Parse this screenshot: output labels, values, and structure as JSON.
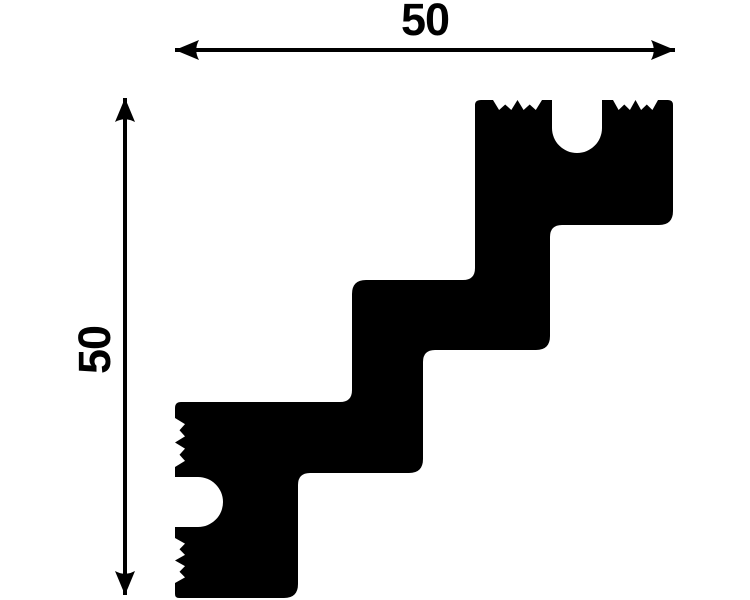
{
  "diagram": {
    "type": "molding-profile-cross-section",
    "background_color": "#ffffff",
    "shape_color": "#000000",
    "line_color": "#000000",
    "dimensions": {
      "width": {
        "value": "50",
        "orientation": "horizontal",
        "position": "top"
      },
      "height": {
        "value": "50",
        "orientation": "vertical",
        "position": "left"
      }
    },
    "geometry": {
      "profile_path": "M 481,100 L 493,100 L 499.1,110 L 505.2,104.5 L 511.3,110 L 517.5,100 L 523.6,110 L 529.7,104.5 L 535.8,110 L 542,100 L 552,100 L 552,128 A 25,25 0 0 0 602,128 L 602,100 L 613,100 L 618.6,110 L 624.3,104.5 L 629.9,110 L 635.5,100 L 641.1,110 L 646.8,104.5 L 652.4,110 L 658,100 L 668,100 Q 673,100 673,105 L 673,211 Q 673,225 659,225 L 562,225 Q 550,225 550,237 L 550,336 Q 550,350 536,350 L 435,350 Q 423,350 423,362 L 423,459 Q 423,473 409,473 L 310,473 Q 298,473 298,485 L 298,584 Q 298,598 284,598 L 179,598 Q 175,598 175,594 L 175,583 L 185,577.4 L 179.5,571.7 L 185,566.1 L 175,560.5 L 185,554.9 L 179.5,549.2 L 185,543.6 L 175,538 L 175,527 L 198,527 A 25,25 0 0 0 198,477 L 175,477 L 175,467 L 185,460.9 L 179.5,454.7 L 185,448.6 L 175,442.5 L 185,436.4 L 179.5,430.2 L 185,424.1 L 175,418 L 175,408 Q 175,402 181,402 L 340,402 Q 352,402 352,390 L 352,294 Q 352,280 366,280 L 463,280 Q 475,280 475,268 L 475,105 Q 475,100 481,100 Z",
      "width_dimension_line": "M 175,50 L 675,50",
      "width_arrowhead_left": "M 175,50 L 199,40 Q 193.5,50 199,60 Z",
      "width_arrowhead_right": "M 675,50 L 651,40 Q 656.5,50 651,60 Z",
      "height_dimension_line": "M 125,98 L 125,595",
      "height_arrowhead_top": "M 125,98 L 115,122 Q 125,116.5 135,122 Z",
      "height_arrowhead_bottom": "M 125,595 L 115,571 Q 125,576.5 135,571 Z",
      "width_label_x": "425",
      "width_label_y": "35",
      "height_label_transform": "translate(110,350) rotate(-90)",
      "stroke_width": "4"
    }
  }
}
